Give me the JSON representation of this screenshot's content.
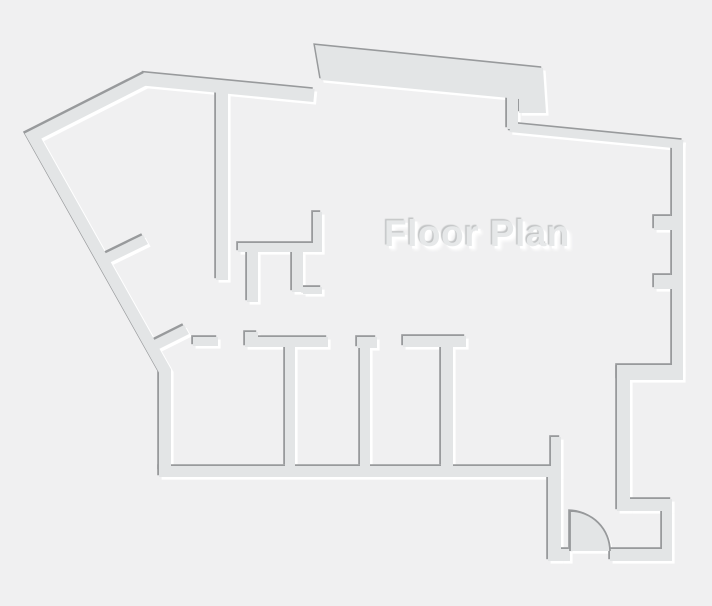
{
  "title": "Floor Plan",
  "colors": {
    "background": "#f0f0f1",
    "wall_fill": "#e3e5e6",
    "wall_shadow": "#989a9c",
    "wall_highlight": "#ffffff",
    "door_line": "#97999b",
    "label_fill": "#e6e8e9",
    "label_shadow_dark": "#c2c4c5"
  },
  "features": [
    "door-swing-bottom-right",
    "window-jambs-right-wall",
    "four-rooms-bottom-strip",
    "diagonal-wall-top-left"
  ]
}
